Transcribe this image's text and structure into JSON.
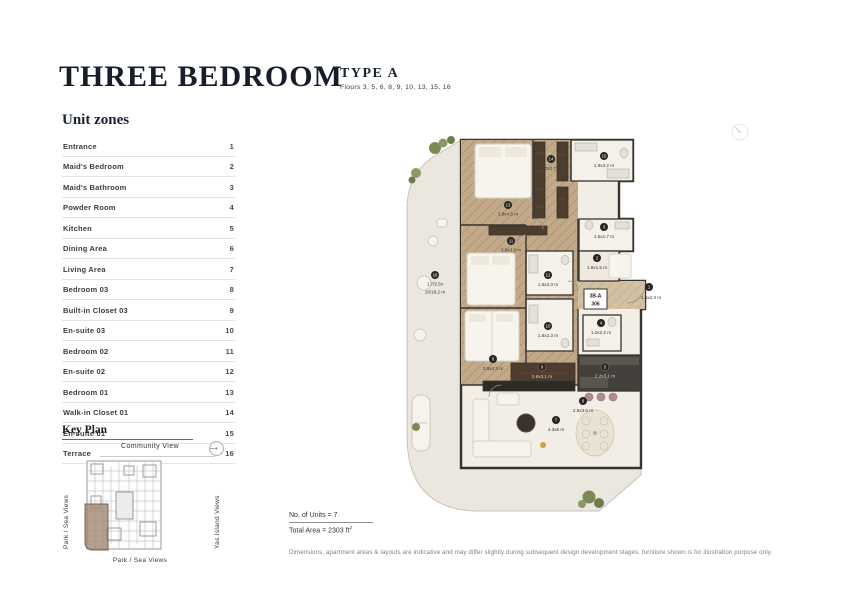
{
  "header": {
    "title": "THREE BEDROOM",
    "type_label": "TYPE A",
    "floors": "Floors 3, 5, 6, 8, 9, 10, 13, 15, 16"
  },
  "unit_zones": {
    "heading": "Unit zones",
    "items": [
      {
        "label": "Entrance",
        "num": "1"
      },
      {
        "label": "Maid's Bedroom",
        "num": "2"
      },
      {
        "label": "Maid's Bathroom",
        "num": "3"
      },
      {
        "label": "Powder Room",
        "num": "4"
      },
      {
        "label": "Kitchen",
        "num": "5"
      },
      {
        "label": "Dining Area",
        "num": "6"
      },
      {
        "label": "Living Area",
        "num": "7"
      },
      {
        "label": "Bedroom 03",
        "num": "8"
      },
      {
        "label": "Built-in Closet 03",
        "num": "9"
      },
      {
        "label": "En-suite 03",
        "num": "10"
      },
      {
        "label": "Bedroom 02",
        "num": "11"
      },
      {
        "label": "En-suite 02",
        "num": "12"
      },
      {
        "label": "Bedroom 01",
        "num": "13"
      },
      {
        "label": "Walk-in Closet 01",
        "num": "14"
      },
      {
        "label": "En-suite 01",
        "num": "15"
      },
      {
        "label": "Terrace",
        "num": "16"
      }
    ]
  },
  "key_plan": {
    "heading": "Key Plan",
    "top_label": "Community View",
    "left_label": "Park / Sea Views",
    "right_label": "Yas Island Views",
    "bottom_label": "Park / Sea Views",
    "compass_icon": "north-compass",
    "highlight_color": "#9e8470"
  },
  "floorplan": {
    "unit_code": "3B-A",
    "unit_number": "306",
    "rooms": [
      {
        "num": "1",
        "name": "Entrance",
        "dims": "1.6x2.3 m"
      },
      {
        "num": "2",
        "name": "Maid's Bedroom",
        "dims": "1.9x1.5 m"
      },
      {
        "num": "3",
        "name": "Maid's Bathroom",
        "dims": "1.5x1.7 m"
      },
      {
        "num": "4",
        "name": "Powder Room",
        "dims": "1.2x2.2 m"
      },
      {
        "num": "5",
        "name": "Kitchen",
        "dims": "2.2x3.1 m"
      },
      {
        "num": "6",
        "name": "Dining Area",
        "dims": "2.5x3.5 m"
      },
      {
        "num": "7",
        "name": "Living Area",
        "dims": "4.3x6 m"
      },
      {
        "num": "8",
        "name": "Bedroom 03",
        "dims": "3.5x4.3 m"
      },
      {
        "num": "9",
        "name": "Built-in Closet 03",
        "dims": "0.6x3.1 m"
      },
      {
        "num": "10",
        "name": "En-suite 03",
        "dims": "1.6x2.3 m"
      },
      {
        "num": "11",
        "name": "Bedroom 02",
        "dims": "3.5x3.9 m"
      },
      {
        "num": "12",
        "name": "En-suite 02",
        "dims": "1.6x2.3 m"
      },
      {
        "num": "13",
        "name": "Bedroom 01",
        "dims": "3.9x4.5 m"
      },
      {
        "num": "14",
        "name": "Walk-in Closet 01",
        "dims": "1.7x2.7 m"
      },
      {
        "num": "15",
        "name": "En-suite 01",
        "dims": "1.9x3.2 m"
      },
      {
        "num": "16",
        "name": "Terrace",
        "dims": "1.7/2.5x",
        "dims2": "10/18.2 m"
      }
    ],
    "colors": {
      "wood_floor": "#c2aa8b",
      "walls": "#37342e",
      "terrace": "#ebe7de",
      "dark_joinery": "#4e3d2e",
      "greenery": "#7b8a54"
    }
  },
  "footer": {
    "units_line": "No. of Units = 7",
    "area_line": "Total Area = 2303 ft",
    "area_sup": "2",
    "disclaimer": "Dimensions, apartment areas & layouts are indicative and may differ slightly during subsequent design development stages. furniture shown is for illustration purpose only."
  }
}
